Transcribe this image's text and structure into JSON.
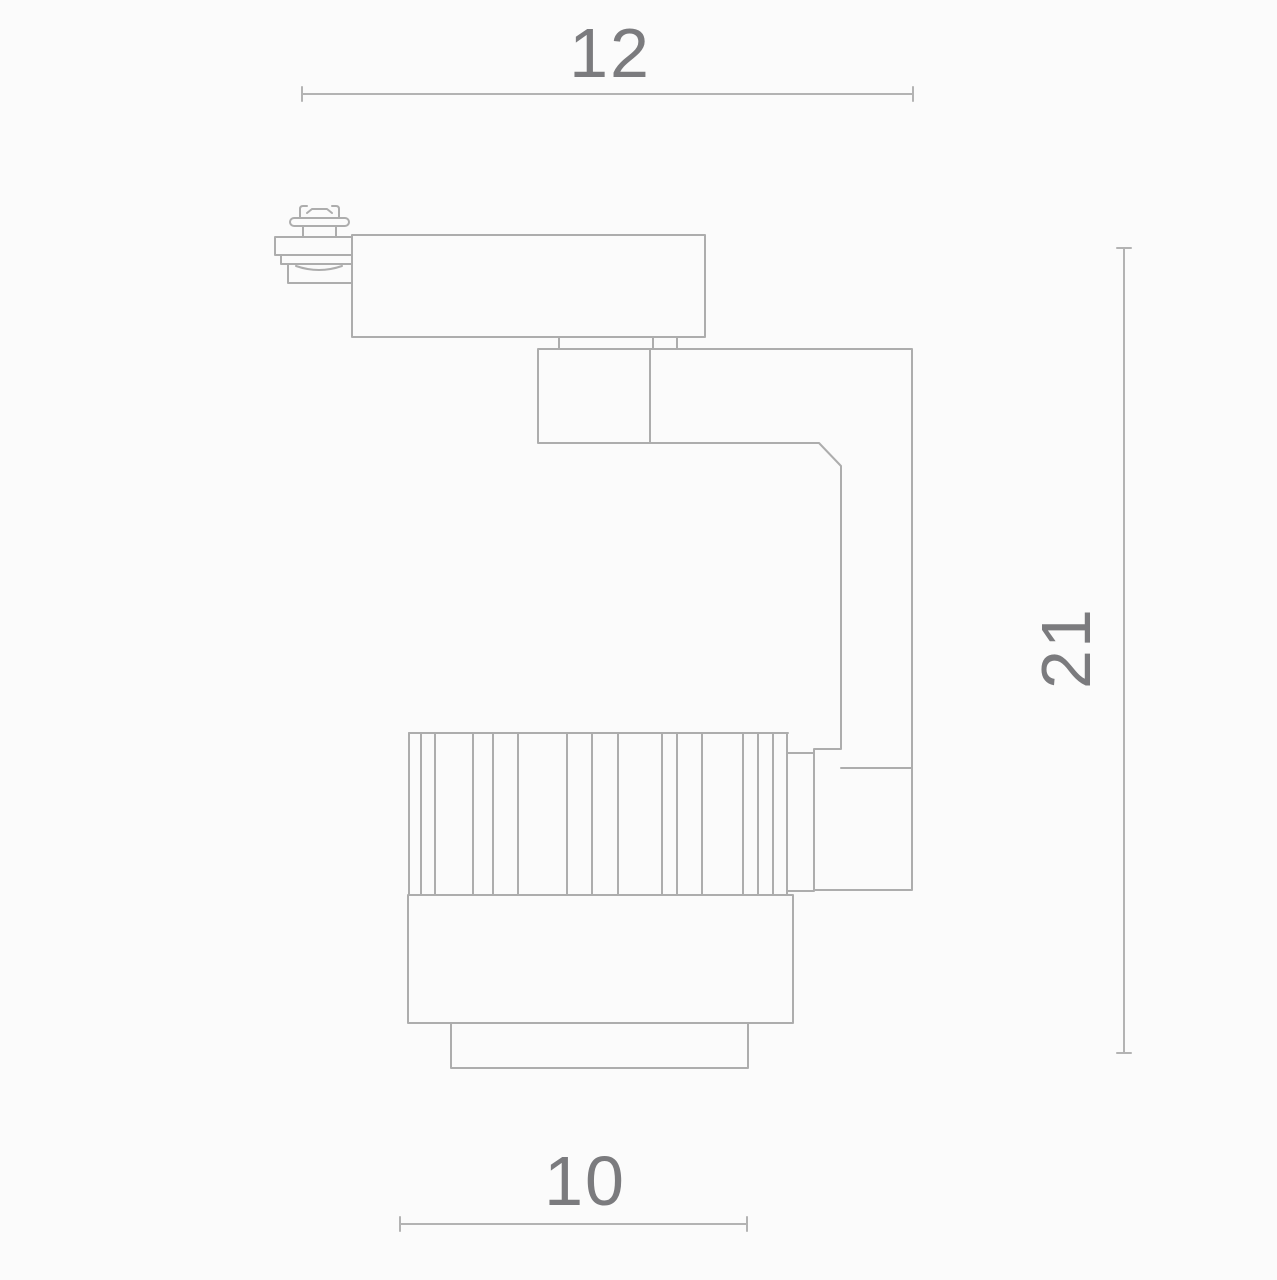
{
  "drawing": {
    "background_color": "#fbfbfb",
    "line_color": "#adadad",
    "label_color": "#7b7b7e",
    "dimensions": {
      "top_width": "12",
      "side_height": "21",
      "bottom_width": "10"
    }
  }
}
